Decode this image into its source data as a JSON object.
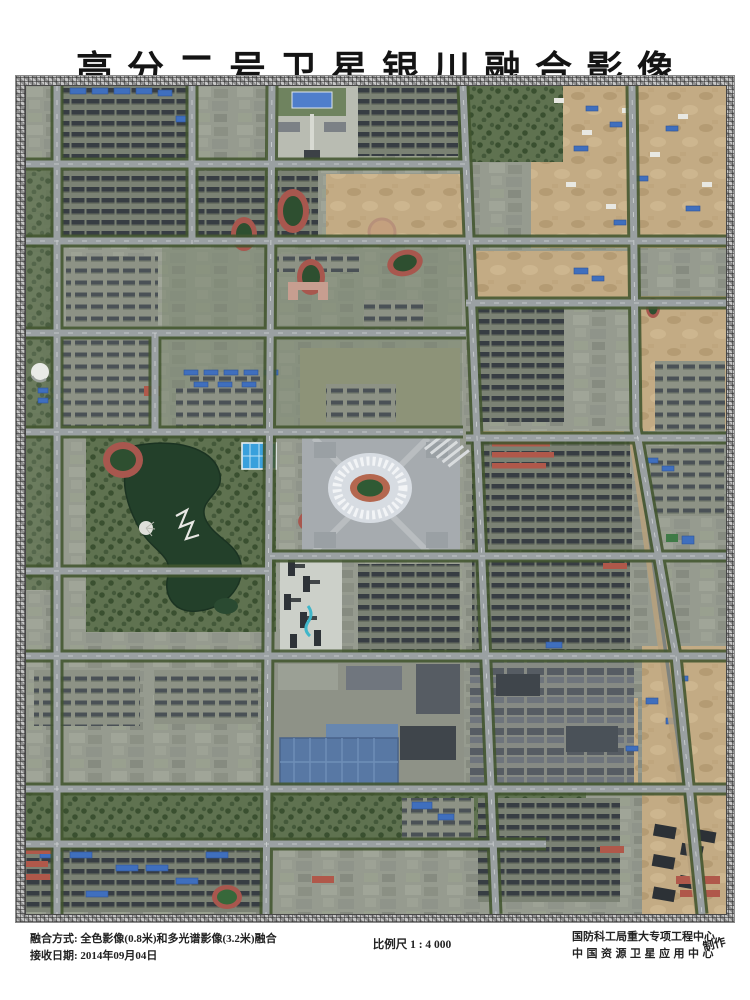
{
  "title": "高分二号卫星银川融合影像",
  "footer": {
    "fusion_line": "融合方式: 全色影像(0.8米)和多光谱影像(3.2米)融合",
    "date_line": "接收日期: 2014年09月04日",
    "scale_text": "比例尺 1 : 4 000",
    "producer_line1": "国防科工局重大专项工程中心",
    "producer_line2": "中国资源卫星应用中心",
    "producer_suffix": "制作"
  },
  "colors": {
    "paper": "#ffffff",
    "ink": "#1c1c1c",
    "frame_gray": "#a8a8a8",
    "road_gray": "#9aa0a2",
    "tree_green": "#42552f",
    "soil_tan": "#c2aa83",
    "lake_green": "#23402a",
    "stadium_white": "#e6eaee",
    "track_red": "#b0584a",
    "roof_blue": "#3f6fbe"
  }
}
